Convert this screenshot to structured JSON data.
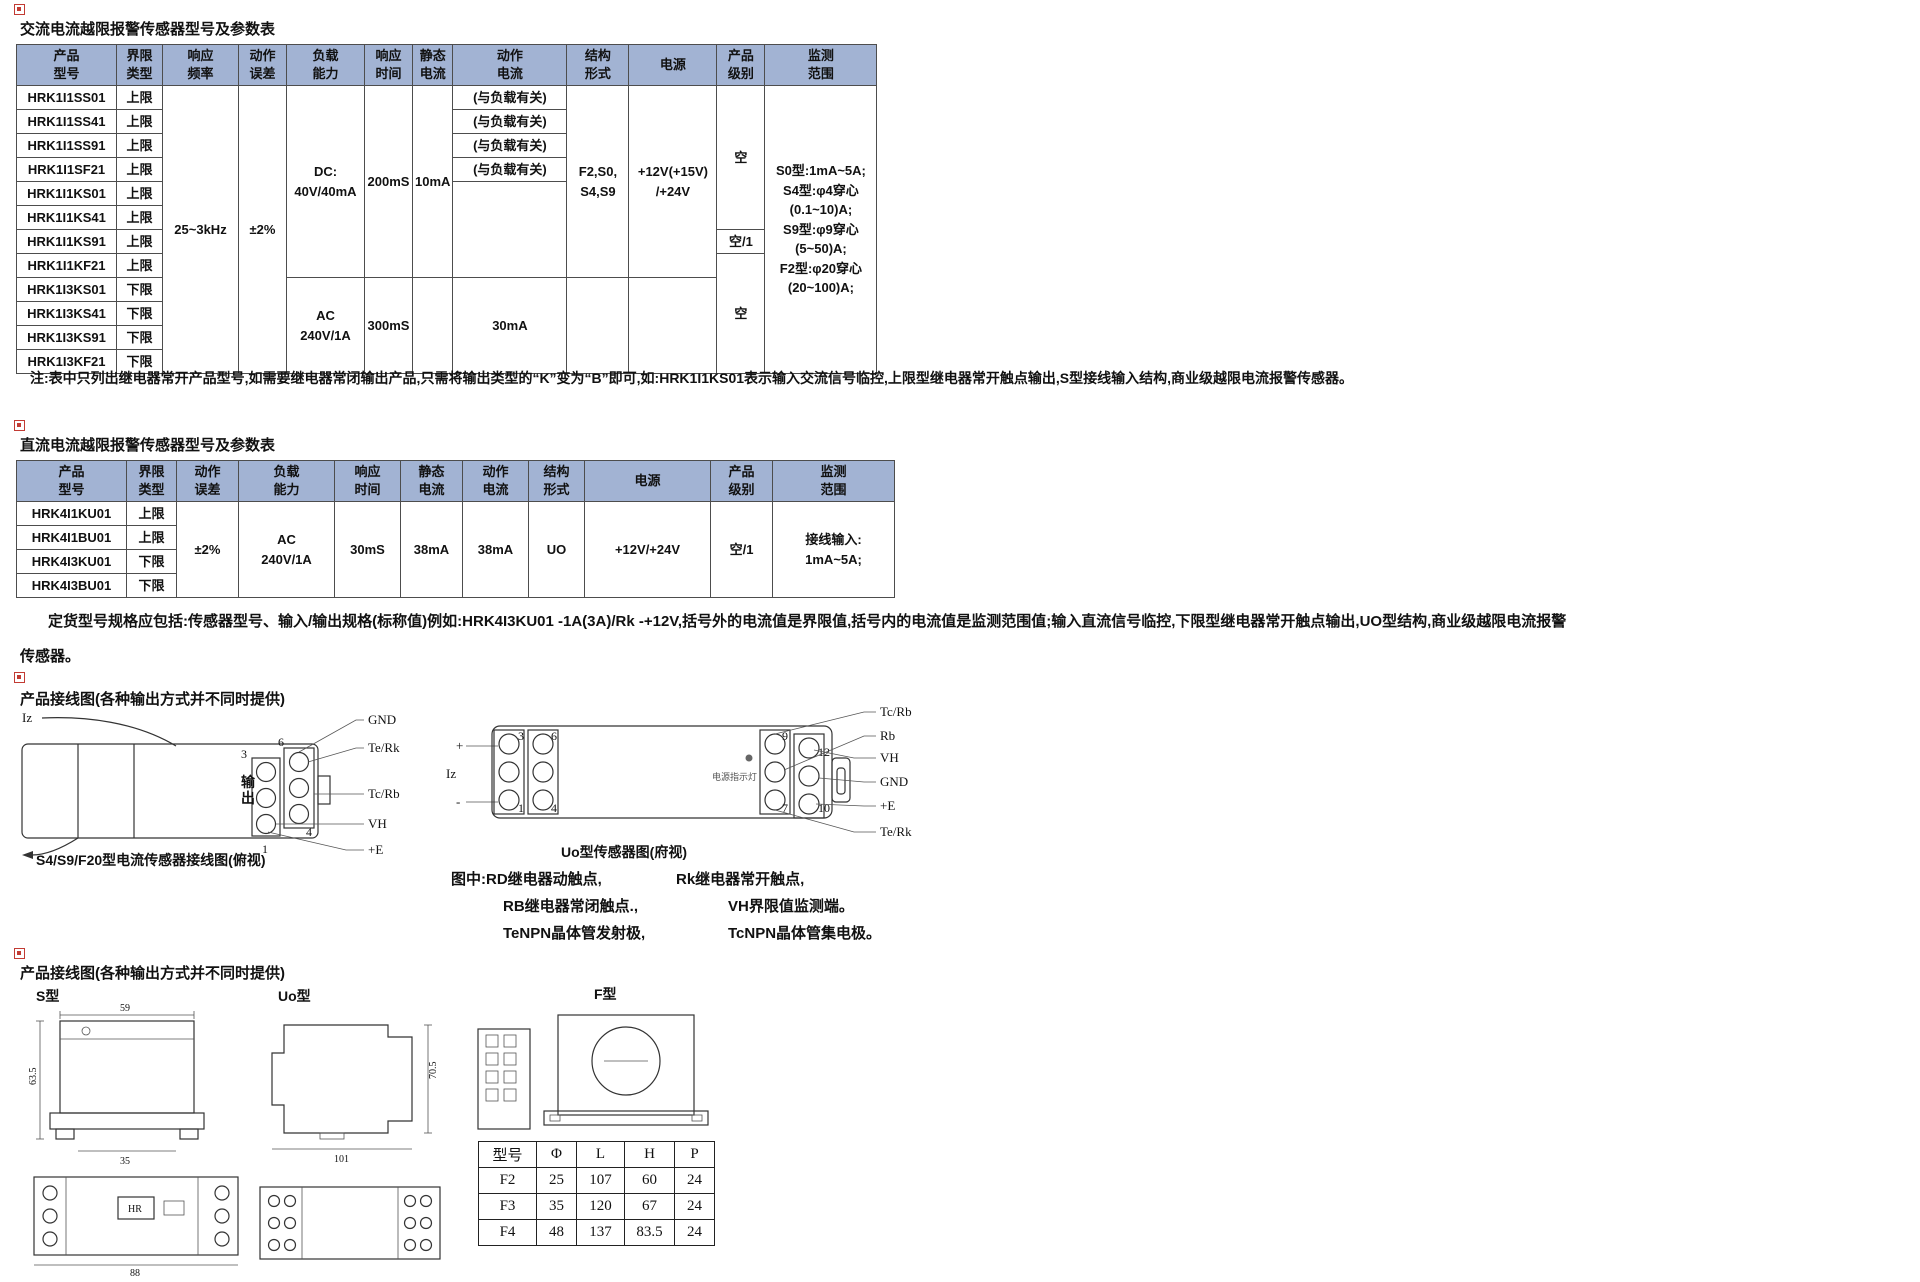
{
  "colors": {
    "table_header_bg": "#a2b3d3",
    "table_border": "#4d4d4d",
    "marker_red": "#c23b33",
    "text": "#111111"
  },
  "ac_section": {
    "title": "交流电流越限报警传感器型号及参数表",
    "table": {
      "widths": [
        100,
        46,
        76,
        48,
        78,
        48,
        40,
        114,
        62,
        88,
        48,
        112
      ],
      "header": [
        "产品\n型号",
        "界限\n类型",
        "响应\n频率",
        "动作\n误差",
        "负载\n能力",
        "响应\n时间",
        "静态\n电流",
        "动作\n电流",
        "结构\n形式",
        "电源",
        "产品\n级别",
        "监测\n范围"
      ],
      "rows": [
        [
          {
            "t": "HRK1I1SS01"
          },
          {
            "t": "上限"
          },
          {
            "t": "25~3kHz",
            "rs": 12
          },
          {
            "t": "±2%",
            "rs": 12
          },
          {
            "t": "DC:\n40V/40mA",
            "rs": 8
          },
          {
            "t": "200mS",
            "rs": 8
          },
          {
            "t": "10mA",
            "rs": 8
          },
          {
            "t": "(与负载有关)"
          },
          {
            "t": "F2,S0,\nS4,S9",
            "rs": 8
          },
          {
            "t": "+12V(+15V)\n/+24V",
            "rs": 8
          },
          {
            "t": "空",
            "rs": 6
          },
          {
            "t": "S0型:1mA~5A;\nS4型:φ4穿心\n(0.1~10)A;\nS9型:φ9穿心\n(5~50)A;\nF2型:φ20穿心\n(20~100)A;",
            "rs": 12
          }
        ],
        [
          {
            "t": "HRK1I1SS41"
          },
          {
            "t": "上限"
          },
          {
            "t": "(与负载有关)"
          }
        ],
        [
          {
            "t": "HRK1I1SS91"
          },
          {
            "t": "上限"
          },
          {
            "t": "(与负载有关)"
          }
        ],
        [
          {
            "t": "HRK1I1SF21"
          },
          {
            "t": "上限"
          },
          {
            "t": "(与负载有关)"
          }
        ],
        [
          {
            "t": "HRK1I1KS01"
          },
          {
            "t": "上限"
          },
          {
            "t": "",
            "rs": 4
          }
        ],
        [
          {
            "t": "HRK1I1KS41"
          },
          {
            "t": "上限"
          }
        ],
        [
          {
            "t": "HRK1I1KS91"
          },
          {
            "t": "上限"
          },
          {
            "t": "空/1"
          }
        ],
        [
          {
            "t": "HRK1I1KF21"
          },
          {
            "t": "上限"
          },
          {
            "t": "空",
            "rs": 5
          }
        ],
        [
          {
            "t": "HRK1I3KS01"
          },
          {
            "t": "下限"
          },
          {
            "t": "AC\n240V/1A",
            "rs": 4
          },
          {
            "t": "300mS",
            "rs": 4
          },
          {
            "t": "",
            "rs": 4
          },
          {
            "t": "30mA",
            "rs": 4
          },
          {
            "t": "",
            "rs": 4
          },
          {
            "t": "",
            "rs": 4
          }
        ],
        [
          {
            "t": "HRK1I3KS41"
          },
          {
            "t": "下限"
          }
        ],
        [
          {
            "t": "HRK1I3KS91"
          },
          {
            "t": "下限"
          }
        ],
        [
          {
            "t": "HRK1I3KF21"
          },
          {
            "t": "下限"
          }
        ]
      ]
    },
    "note": "注:表中只列出继电器常开产品型号,如需要继电器常闭输出产品,只需将输出类型的“K”变为“B”即可,如:HRK1I1KS01表示输入交流信号临控,上限型继电器常开触点输出,S型接线输入结构,商业级越限电流报警传感器。"
  },
  "dc_section": {
    "title": "直流电流越限报警传感器型号及参数表",
    "table": {
      "widths": [
        110,
        50,
        62,
        96,
        66,
        62,
        66,
        56,
        126,
        62,
        122
      ],
      "header": [
        "产品\n型号",
        "界限\n类型",
        "动作\n误差",
        "负载\n能力",
        "响应\n时间",
        "静态\n电流",
        "动作\n电流",
        "结构\n形式",
        "电源",
        "产品\n级别",
        "监测\n范围"
      ],
      "rows": [
        [
          {
            "t": "HRK4I1KU01"
          },
          {
            "t": "上限"
          },
          {
            "t": "±2%",
            "rs": 4
          },
          {
            "t": "AC\n240V/1A",
            "rs": 4
          },
          {
            "t": "30mS",
            "rs": 4
          },
          {
            "t": "38mA",
            "rs": 4
          },
          {
            "t": "38mA",
            "rs": 4
          },
          {
            "t": "UO",
            "rs": 4
          },
          {
            "t": "+12V/+24V",
            "rs": 4
          },
          {
            "t": "空/1",
            "rs": 4
          },
          {
            "t": "接线输入:\n1mA~5A;",
            "rs": 4
          }
        ],
        [
          {
            "t": "HRK4I1BU01"
          },
          {
            "t": "上限"
          }
        ],
        [
          {
            "t": "HRK4I3KU01"
          },
          {
            "t": "下限"
          }
        ],
        [
          {
            "t": "HRK4I3BU01"
          },
          {
            "t": "下限"
          }
        ]
      ]
    },
    "ordering_note": {
      "lines": [
        "定货型号规格应包括:传感器型号、输入/输出规格(标称值)例如:HRK4I3KU01 -1A(3A)/Rk -+12V,括号外的电流值是界限值,括号内的电流值是监测范围值;输入直流信号临控,下限型继电器常开触点输出,UO型结构,商业级越限电流报警",
        "传感器。"
      ]
    }
  },
  "wiring_section": {
    "heading": "产品接线图(各种输出方式并不同时提供)",
    "s_diagram": {
      "input_label": "Iz",
      "output_label": "输出",
      "terminals": [
        "3",
        "6",
        "1",
        "4"
      ],
      "pins": [
        "GND",
        "Te/Rk",
        "Tc/Rb",
        "VH",
        "+E"
      ],
      "caption": "S4/S9/F20型电流传感器接线图(俯视)"
    },
    "uo_diagram": {
      "polarity_plus": "+",
      "polarity_minus": "-",
      "input_label": "Iz",
      "left_terminals": [
        "3",
        "6",
        "1",
        "4"
      ],
      "right_terminals": [
        "9",
        "12",
        "7",
        "10"
      ],
      "led_label": "电源指示灯",
      "pins": [
        "Tc/Rb",
        "Rb",
        "VH",
        "GND",
        "+E",
        "Te/Rk"
      ],
      "caption": "Uo型传感器图(府视)"
    },
    "legend": [
      [
        "图中:RD继电器动触点,",
        "Rk继电器常开触点,"
      ],
      [
        "RB继电器常闭触点.,",
        "VH界限值监测端。"
      ],
      [
        "TeNPN晶体管发射极,",
        "TcNPN晶体管集电极。"
      ]
    ]
  },
  "outline_section": {
    "heading": "产品接线图(各种输出方式并不同时提供)",
    "type_labels": [
      "S型",
      "Uo型",
      "F型"
    ],
    "s_dims": {
      "top": "59",
      "left": "63.5",
      "bottom": "35",
      "width": "88",
      "label": "HR"
    },
    "uo_dims": {
      "height": "70.5",
      "width": "101"
    },
    "f_table": {
      "plain": true,
      "widths": [
        58,
        40,
        48,
        50,
        40
      ],
      "header": [
        "型号",
        "Φ",
        "L",
        "H",
        "P"
      ],
      "rows": [
        [
          {
            "t": "F2"
          },
          {
            "t": "25"
          },
          {
            "t": "107"
          },
          {
            "t": "60"
          },
          {
            "t": "24"
          }
        ],
        [
          {
            "t": "F3"
          },
          {
            "t": "35"
          },
          {
            "t": "120"
          },
          {
            "t": "67"
          },
          {
            "t": "24"
          }
        ],
        [
          {
            "t": "F4"
          },
          {
            "t": "48"
          },
          {
            "t": "137"
          },
          {
            "t": "83.5"
          },
          {
            "t": "24"
          }
        ]
      ]
    }
  }
}
